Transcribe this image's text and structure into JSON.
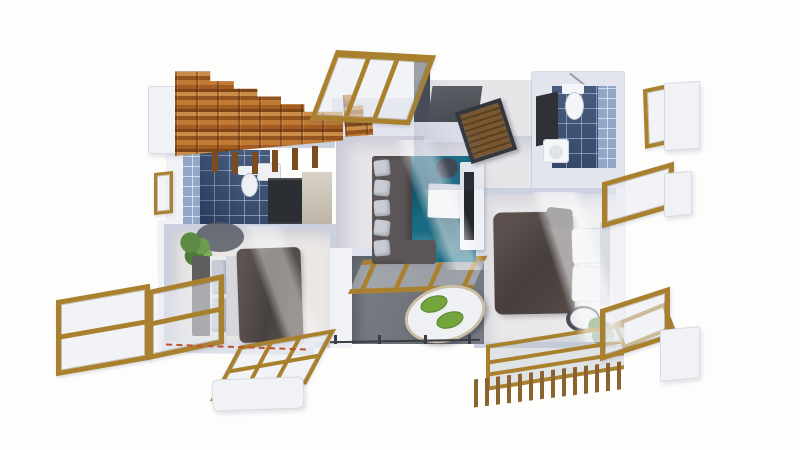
{
  "scene": {
    "title": "3D architectural floor plan render, top-down view with exploded windows",
    "view": "top-down isometric",
    "background": "white"
  },
  "colors": {
    "background": "#fdfdfc",
    "wall": "#ccd1e0",
    "wall-light": "#e2e5ee",
    "wall-white": "#f1f2f6",
    "floor": "#e7e5e8",
    "floor-warm": "#eae7e5",
    "tile-dark": "#3e5377",
    "tile-light": "#92a6c6",
    "wood-frame": "#a9812e",
    "wood-slat": "#8a6330",
    "rug-teal": "#176b83",
    "sofa-gray": "#5b5557",
    "duvet-gray": "#4f4947",
    "pillow-light": "#c9ccd4",
    "white-furniture": "#eff0f4",
    "counter-dark": "#2e3237",
    "wardrobe-dark": "#2b2e32",
    "balcony-floor": "#74777f",
    "chair-green": "#74a43c",
    "plant-green": "#5d8a44",
    "railing-dark": "#3a3d42",
    "dash-red": "#c0512f",
    "niche-dark": "#45484d",
    "tv-black": "#23262b",
    "stool-dark": "#3d434b"
  },
  "rooms": [
    {
      "id": "staircase",
      "label": "Wooden staircase",
      "furniture": [
        "wood steps",
        "balusters",
        "landing panel"
      ]
    },
    {
      "id": "entry-hall",
      "label": "Entry hall with dark niche and slatted door",
      "furniture": [
        "slatted wood door",
        "dark panel"
      ]
    },
    {
      "id": "bathroom-top-right",
      "label": "Bathroom (top right)",
      "furniture": [
        "toilet",
        "washbasin",
        "dark vanity counter",
        "blue tile floor"
      ]
    },
    {
      "id": "bathroom-left",
      "label": "Bathroom under stairs",
      "furniture": [
        "toilet",
        "washbasin",
        "dark wardrobe",
        "blue tile floor"
      ]
    },
    {
      "id": "living-room",
      "label": "Living room",
      "furniture": [
        "corner sofa with pillows",
        "teal area rug",
        "white coffee table",
        "round side stool",
        "tv console with tv"
      ]
    },
    {
      "id": "bedroom-left",
      "label": "Bedroom (left)",
      "furniture": [
        "double bed with dark duvet",
        "headboard",
        "pillows",
        "potted plant",
        "round dark rug"
      ]
    },
    {
      "id": "bedroom-right",
      "label": "Bedroom (right)",
      "furniture": [
        "double bed with dark duvet",
        "white pillows",
        "round side table",
        "potted plant"
      ]
    },
    {
      "id": "balcony",
      "label": "Balcony terrace",
      "furniture": [
        "oval white table",
        "two green chairs",
        "wood-glass canopy",
        "thin dark railing"
      ]
    },
    {
      "id": "pergola-deck",
      "label": "Slatted pergola deck (bottom right)",
      "furniture": [
        "wood slats",
        "glass panel with gold beams",
        "gold railing"
      ]
    }
  ],
  "floating_elements": [
    {
      "id": "window-top",
      "label": "Tilted gold wood-frame window (top center)"
    },
    {
      "id": "window-left-outer",
      "label": "Gold wood-frame window, two panes (bottom left outer)"
    },
    {
      "id": "window-left-inner",
      "label": "Gold wood-frame window, two panes (bottom left inner)"
    },
    {
      "id": "window-flat-bottom",
      "label": "Gold wood-frame window lying flat (bottom)"
    },
    {
      "id": "window-right-top",
      "label": "Small gold frame with white shutter panel (right top)"
    },
    {
      "id": "window-right-mid",
      "label": "Angled gold frame with white shutter panel (right middle)"
    },
    {
      "id": "window-right-low",
      "label": "Angled gold frame with white shutter panel (right lower)"
    },
    {
      "id": "frame-small-left",
      "label": "Small vertical gold frame (left)"
    },
    {
      "id": "panel-stair-landing",
      "label": "White panel beside staircase"
    },
    {
      "id": "panel-bottom-left",
      "label": "White panel below flat window"
    },
    {
      "id": "boundary-dashes",
      "label": "Red dashed property line (bottom left)"
    }
  ]
}
